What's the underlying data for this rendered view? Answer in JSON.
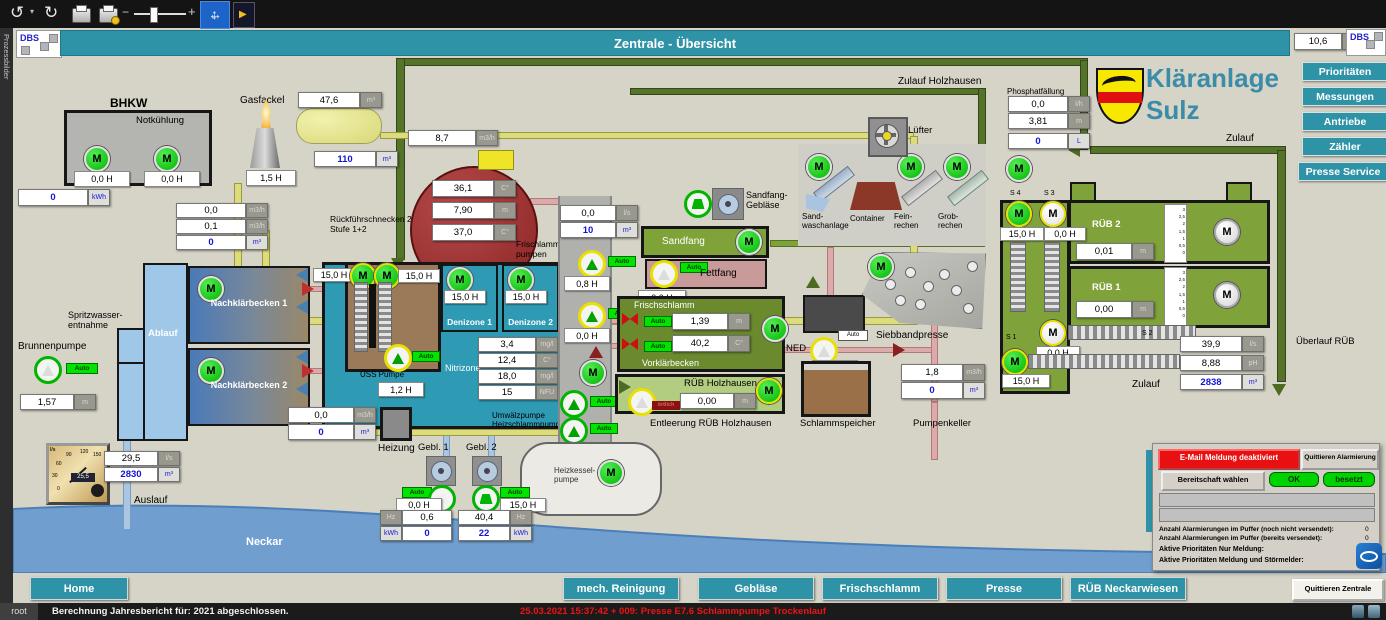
{
  "window": {
    "side_label": "Prozessbilder",
    "title": "Zentrale - Übersicht",
    "logo": "DBS",
    "temp": {
      "val": "10,6",
      "unit": "C°"
    }
  },
  "brand": {
    "line1": "Kläranlage",
    "line2": "Sulz"
  },
  "nav_right": {
    "prioritaeten": "Prioritäten",
    "messungen": "Messungen",
    "antriebe": "Antriebe",
    "zaehler": "Zähler",
    "presse_service": "Presse Service"
  },
  "nav_bottom": {
    "home": "Home",
    "mech": "mech. Reinigung",
    "geblaese": "Gebläse",
    "frischschlamm": "Frischschlamm",
    "presse": "Presse",
    "rueb": "RÜB Neckarwiesen",
    "quittieren": "Quittieren Zentrale"
  },
  "labels": {
    "m": "M",
    "auto": "Auto",
    "oertlich": "örtlich",
    "bhkw": "BHKW",
    "notkuehlung": "Notkühlung",
    "gasfackel": "Gasfackel",
    "rueckfuehr": "Rückführschnecken 2\nStufe 1+2",
    "frischlamm_pumpen": "Frischlamm-\npumpen",
    "spritzwasser": "Spritzwasser-\nentnahme",
    "brunnenpumpe": "Brunnenpumpe",
    "ablauf": "Ablauf",
    "nkb1": "Nachklärbecken 1",
    "nkb2": "Nachklärbecken 2",
    "uess": "ÜSS Pumpe",
    "denizone1": "Denizone 1",
    "denizone2": "Denizone 2",
    "nitrizone": "Nitrizone",
    "umwaelz": "Umwälzpumpe\nHeizschlammpumpe",
    "heizung": "Heizung",
    "gebl1": "Gebl. 1",
    "gebl2": "Gebl. 2",
    "heizkessel": "Heizkessel-\npumpe",
    "sandfang": "Sandfang",
    "sandfang_geblaese": "Sandfang-\nGebläse",
    "fettfang": "Fettfang",
    "frischschlamm": "Frischschlamm",
    "vorklaerbecken": "Vorklärbecken",
    "rueb_holzhausen": "RÜB Holzhausen",
    "entleerung": "Entleerung RÜB Holzhausen",
    "ned": "NED",
    "schlammspeicher": "Schlammspeicher",
    "siebbandpresse": "Siebbandpresse",
    "pumpenkeller": "Pumpenkeller",
    "zulauf_holzhausen": "Zulauf Holzhausen",
    "phosphat": "Phosphatfällung",
    "luefter": "Lüfter",
    "sandwasch": "Sand-\nwaschanlage",
    "container": "Container",
    "feinrechen": "Fein-\nrechen",
    "grobrechen": "Grob-\nrechen",
    "s4": "S 4",
    "s3": "S 3",
    "s2": "S 2",
    "s1": "S 1",
    "rueb2": "RÜB 2",
    "rueb1": "RÜB 1",
    "zulauf": "Zulauf",
    "ueberlauf": "Überlauf RÜB",
    "auslauf": "Auslauf",
    "neckar": "Neckar",
    "scale": "3\n2,5\n2\n1,5\n1\n0,5\n0"
  },
  "v": {
    "bhkw_m1": "0,0 H",
    "bhkw_m2": "0,0 H",
    "bhkw_kwh": {
      "val": "0",
      "unit": "kWh"
    },
    "fackel_h": "1,5 H",
    "gas_vol": {
      "val": "47,6",
      "unit": "m³"
    },
    "gas_level": {
      "val": "110",
      "unit": "m³"
    },
    "gas_flow": {
      "val": "8,7",
      "unit": "m3/h"
    },
    "rf1": {
      "val": "0,0",
      "unit": "m3/h"
    },
    "rf2": {
      "val": "0,1",
      "unit": "m3/h"
    },
    "rf3": {
      "val": "0",
      "unit": "m³"
    },
    "ft_t1": {
      "val": "36,1",
      "unit": "C°"
    },
    "ft_lvl": {
      "val": "7,90",
      "unit": "m"
    },
    "ft_t2": {
      "val": "37,0",
      "unit": "C°"
    },
    "uess_m1": "15,0 H",
    "uess_m2": "15,0 H",
    "uess_p": "1,2 H",
    "deni1": "15,0 H",
    "deni2": "15,0 H",
    "ni1": {
      "val": "3,4",
      "unit": "mg/l"
    },
    "ni2": {
      "val": "12,4",
      "unit": "C°"
    },
    "ni3": {
      "val": "18,0",
      "unit": "mg/l"
    },
    "ni4": {
      "val": "15",
      "unit": "NFU"
    },
    "brunnen": {
      "val": "1,57",
      "unit": "m"
    },
    "heiz1": {
      "val": "0,0",
      "unit": "m3/h"
    },
    "heiz2": {
      "val": "0",
      "unit": "m³"
    },
    "g1_h": "0,0 H",
    "g2_h": "15,0 H",
    "g1_hz": {
      "val": "0,6",
      "unit": "Hz"
    },
    "g1_kwh": {
      "val": "0",
      "unit": "kWh"
    },
    "g2_hz": {
      "val": "40,4",
      "unit": "Hz"
    },
    "g2_kwh": {
      "val": "22",
      "unit": "kWh"
    },
    "fp_ls": {
      "val": "0,0",
      "unit": "l/s"
    },
    "fp_vol": {
      "val": "10",
      "unit": "m³"
    },
    "p1_h": "0,8 H",
    "p2_h": "0,0 H",
    "fett_h": "0,0 H",
    "fs_lvl": {
      "val": "1,39",
      "unit": "m"
    },
    "fs_t": {
      "val": "40,2",
      "unit": "C°"
    },
    "rh_lvl": {
      "val": "0,00",
      "unit": "m"
    },
    "ned_h": "0,0 H",
    "pk_flow": {
      "val": "1,8",
      "unit": "m3/h"
    },
    "pk_vol": {
      "val": "0",
      "unit": "m³"
    },
    "ph1": {
      "val": "0,0",
      "unit": "l/h"
    },
    "ph2": {
      "val": "3,81",
      "unit": "m"
    },
    "ph3": {
      "val": "0",
      "unit": "L"
    },
    "s4_h": "15,0 H",
    "s3_h": "0,0 H",
    "s2_h": "0,0 H",
    "s1_h": "15,0 H",
    "rueb2_lvl": {
      "val": "0,01",
      "unit": "m"
    },
    "rueb1_lvl": {
      "val": "0,00",
      "unit": "m"
    },
    "zl_ls": {
      "val": "39,9",
      "unit": "l/s"
    },
    "zl_ph": {
      "val": "8,88",
      "unit": "pH"
    },
    "zl_vol": {
      "val": "2838",
      "unit": "m³"
    },
    "al_ls": {
      "val": "29,5",
      "unit": "l/s"
    },
    "al_vol": {
      "val": "2830",
      "unit": "m³"
    }
  },
  "gauge": {
    "unit": "l/s",
    "reading": "25,5",
    "t0": "0",
    "t30": "30",
    "t60": "60",
    "t90": "90",
    "t120": "120",
    "t150": "150"
  },
  "alarm": {
    "email": "E-Mail Meldung deaktiviert",
    "quit": "Quittieren Alarmierung",
    "bereitschaft": "Bereitschaft wählen",
    "ok": "OK",
    "besetzt": "besetzt",
    "line1": "Anzahl Alarmierungen im Puffer (noch nicht versendet):",
    "line1_val": "0",
    "line2": "Anzahl Alarmierungen im Puffer (bereits versendet):",
    "line2_val": "0",
    "line3": "Aktive Prioritäten Nur Meldung:",
    "line3_val": "1",
    "line4": "Aktive Prioritäten Meldung und  Störmelder:",
    "line4_val": "S"
  },
  "status": {
    "user": "root",
    "msg": "Berechnung Jahresbericht für: 2021 abgeschlossen.",
    "alarm": "25.03.2021 15:37:42 + 009:  Presse E7.6 Schlammpumpe Trockenlauf"
  }
}
